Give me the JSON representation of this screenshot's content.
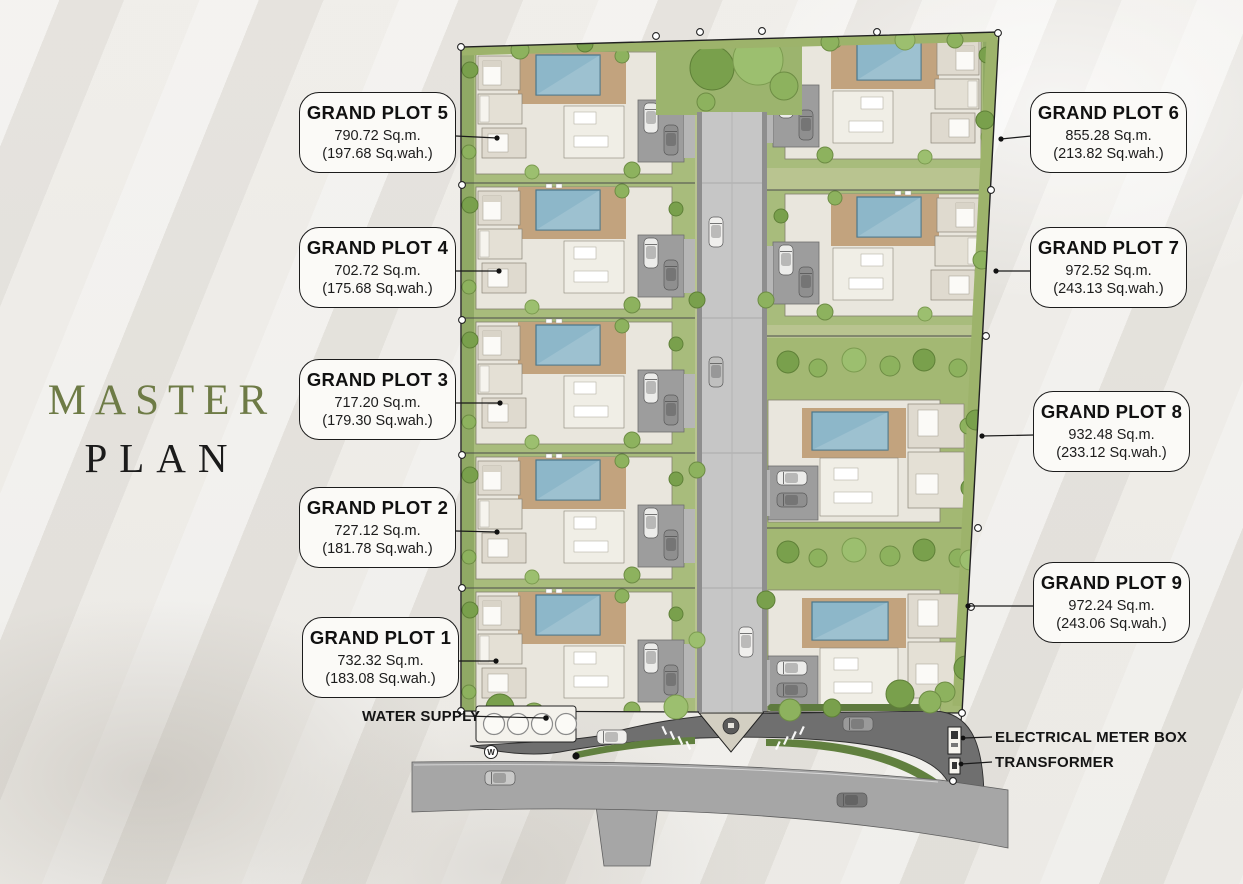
{
  "title": {
    "line1": "MASTER",
    "line2": "PLAN"
  },
  "plots": [
    {
      "name": "GRAND PLOT 5",
      "area_sqm": "790.72 Sq.m.",
      "area_sqwah": "(197.68 Sq.wah.)"
    },
    {
      "name": "GRAND PLOT 4",
      "area_sqm": "702.72 Sq.m.",
      "area_sqwah": "(175.68 Sq.wah.)"
    },
    {
      "name": "GRAND PLOT 3",
      "area_sqm": "717.20 Sq.m.",
      "area_sqwah": "(179.30 Sq.wah.)"
    },
    {
      "name": "GRAND PLOT 2",
      "area_sqm": "727.12 Sq.m.",
      "area_sqwah": "(181.78 Sq.wah.)"
    },
    {
      "name": "GRAND PLOT 1",
      "area_sqm": "732.32 Sq.m.",
      "area_sqwah": "(183.08 Sq.wah.)"
    },
    {
      "name": "GRAND PLOT 6",
      "area_sqm": "855.28 Sq.m.",
      "area_sqwah": "(213.82 Sq.wah.)"
    },
    {
      "name": "GRAND PLOT 7",
      "area_sqm": "972.52 Sq.m.",
      "area_sqwah": "(243.13 Sq.wah.)"
    },
    {
      "name": "GRAND PLOT 8",
      "area_sqm": "932.48 Sq.m.",
      "area_sqwah": "(233.12 Sq.wah.)"
    },
    {
      "name": "GRAND PLOT 9",
      "area_sqm": "972.24 Sq.m.",
      "area_sqwah": "(243.06 Sq.wah.)"
    }
  ],
  "annotations": {
    "water_supply": "WATER SUPPLY",
    "electrical_meter_box": "ELECTRICAL METER BOX",
    "transformer": "TRANSFORMER",
    "water_symbol": "W"
  },
  "colors": {
    "title_accent": "#6e7b46",
    "grass": "#a8bc7c",
    "tree": "#79a04c",
    "pool": "#8db7c9",
    "deck": "#c2a37e",
    "building": "#e9e6dd",
    "internal_road": "#c6c6c6",
    "access_road": "#6f6f6f",
    "public_road": "#a6a6a6",
    "label_bg": "#fbfaf7",
    "label_border": "#1c1c1c"
  }
}
